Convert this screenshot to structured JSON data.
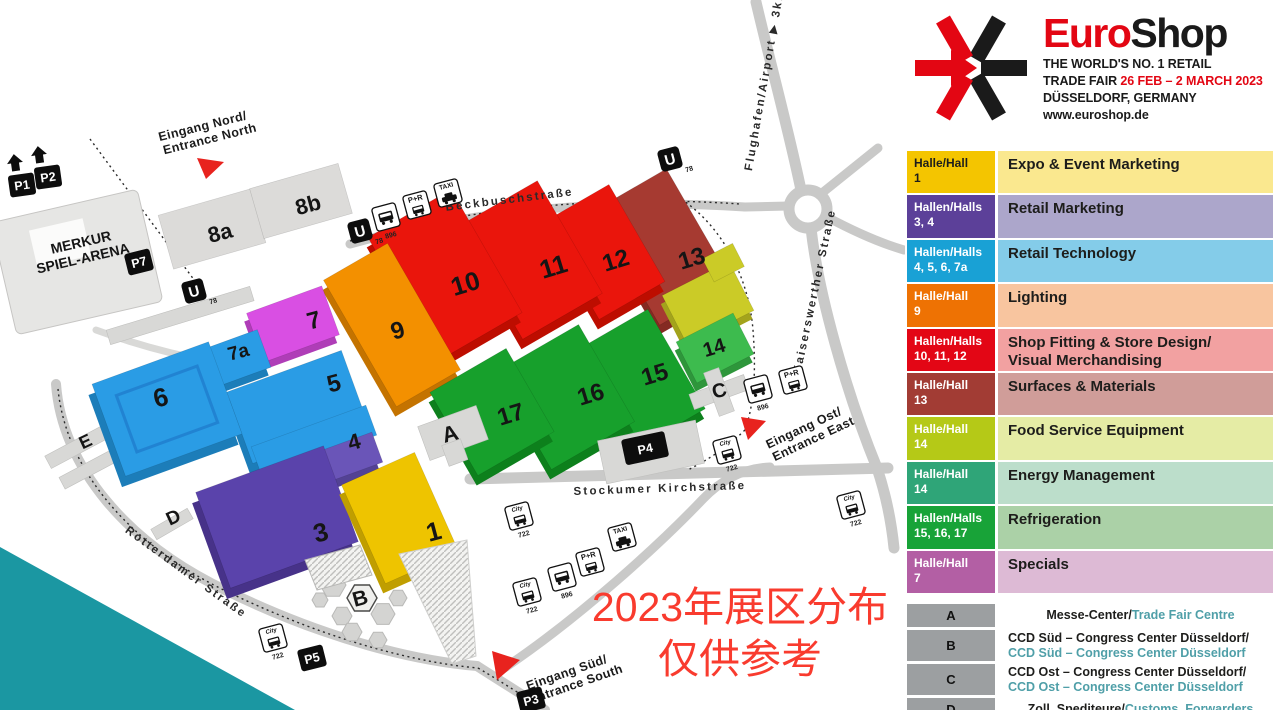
{
  "note": {
    "line1": "2023年展区分布",
    "line2": "仅供参考",
    "color": "#f93b2e"
  },
  "logo": {
    "brand_red": "Euro",
    "brand_black": "Shop",
    "accent_red": "#e30613",
    "tagline_line1": "THE WORLD'S NO. 1 RETAIL",
    "tagline_line2_prefix": "TRADE FAIR ",
    "tagline_line2_dates": "26 FEB – 2 MARCH 2023",
    "tagline_line3": "DÜSSELDORF, GERMANY",
    "tagline_line4": "www.euroshop.de"
  },
  "legend": {
    "rows": [
      {
        "hall_label": "Halle/Hall",
        "hall_numbers": "1",
        "category": "Expo & Event Marketing",
        "label_color": "#f4c500",
        "body_color": "#fae88f"
      },
      {
        "hall_label": "Hallen/Halls",
        "hall_numbers": "3, 4",
        "category": "Retail Marketing",
        "label_color": "#5c4099",
        "body_color": "#aca6cb"
      },
      {
        "hall_label": "Hallen/Halls",
        "hall_numbers": "4, 5, 6, 7a",
        "category": "Retail Technology",
        "label_color": "#19a1d5",
        "body_color": "#84cce9"
      },
      {
        "hall_label": "Halle/Hall",
        "hall_numbers": "9",
        "category": "Lighting",
        "label_color": "#ee7203",
        "body_color": "#f8c59f"
      },
      {
        "hall_label": "Hallen/Halls",
        "hall_numbers": "10, 11, 12",
        "category": "Shop Fitting & Store Design/\nVisual Merchandising",
        "label_color": "#e30615",
        "body_color": "#f2a1a1"
      },
      {
        "hall_label": "Halle/Hall",
        "hall_numbers": "13",
        "category": "Surfaces & Materials",
        "label_color": "#a23c34",
        "body_color": "#d09d99"
      },
      {
        "hall_label": "Halle/Hall",
        "hall_numbers": "14",
        "category": "Food Service Equipment",
        "label_color": "#b5c917",
        "body_color": "#e5eca5"
      },
      {
        "hall_label": "Halle/Hall",
        "hall_numbers": "14",
        "category": "Energy Management",
        "label_color": "#2fa578",
        "body_color": "#bcdecb"
      },
      {
        "hall_label": "Hallen/Halls",
        "hall_numbers": "15, 16, 17",
        "category": "Refrigeration",
        "label_color": "#18a338",
        "body_color": "#abd1a7"
      },
      {
        "hall_label": "Halle/Hall",
        "hall_numbers": "7",
        "category": "Specials",
        "label_color": "#b35fa4",
        "body_color": "#ddbad5"
      }
    ]
  },
  "facilities": [
    {
      "key": "A",
      "de": "Messe-Center/",
      "en": "Trade Fair Centre"
    },
    {
      "key": "B",
      "de": "CCD Süd – Congress Center Düsseldorf/",
      "en": "CCD Süd – Congress Center Düsseldorf"
    },
    {
      "key": "C",
      "de": "CCD Ost – Congress Center Düsseldorf/",
      "en": "CCD Ost – Congress Center Düsseldorf"
    },
    {
      "key": "D",
      "de": "Zoll, Spediteure/",
      "en": "Customs, Forwarders"
    }
  ],
  "facility_box_color": "#9c9fa1",
  "facility_en_color": "#4f9fa8",
  "map": {
    "streets": {
      "beckbusch": "Beckbuschstraße",
      "kaiserswerther": "Kaiserswerther Straße",
      "stockumer": "Stockumer Kirchstraße",
      "rotterdamer": "Rotterdamer Straße",
      "airport": "Flughafen/Airport ▶ 3km"
    },
    "entrances": {
      "north1": "Eingang Nord/",
      "north2": "Entrance North",
      "east1": "Eingang Ost/",
      "east2": "Entrance East",
      "south1": "Eingang Süd/",
      "south2": "Entrance South"
    },
    "arena_line1": "MERKUR",
    "arena_line2": "SPIEL-ARENA",
    "halls": {
      "h1": "1",
      "h3": "3",
      "h4": "4",
      "h5": "5",
      "h6": "6",
      "h7": "7",
      "h7a": "7a",
      "h8a": "8a",
      "h8b": "8b",
      "h9": "9",
      "h10": "10",
      "h11": "11",
      "h12": "12",
      "h13": "13",
      "h14": "14",
      "h15": "15",
      "h16": "16",
      "h17": "17"
    },
    "hall_colors": {
      "1": "#eec400",
      "3": "#5a43ab",
      "4a": "#2a9ce5",
      "4b": "#6a55b8",
      "5": "#2a9ce5",
      "6": "#2a9ce5",
      "7": "#d94fe3",
      "7a": "#2a9ce5",
      "8": "#dcdbd9",
      "9": "#f39000",
      "10": "#ea150c",
      "11": "#ea150c",
      "12": "#ea150c",
      "13": "#a63a31",
      "14a": "#cbcb27",
      "14b": "#3dbb4e",
      "15": "#17a02c",
      "16": "#17a02c",
      "17": "#17a02c"
    },
    "buildings": {
      "a": "A",
      "b": "B",
      "c": "C",
      "d": "D",
      "e": "E"
    },
    "parking": {
      "p1": "P1",
      "p2": "P2",
      "p3": "P3",
      "p4": "P4",
      "p5": "P5",
      "p7": "P7"
    },
    "transit": {
      "u": "U",
      "u_line": "78",
      "bus_896": "896",
      "bus_722": "722",
      "city": "City",
      "taxi": "TAXI",
      "park_ride": "P+R"
    }
  }
}
